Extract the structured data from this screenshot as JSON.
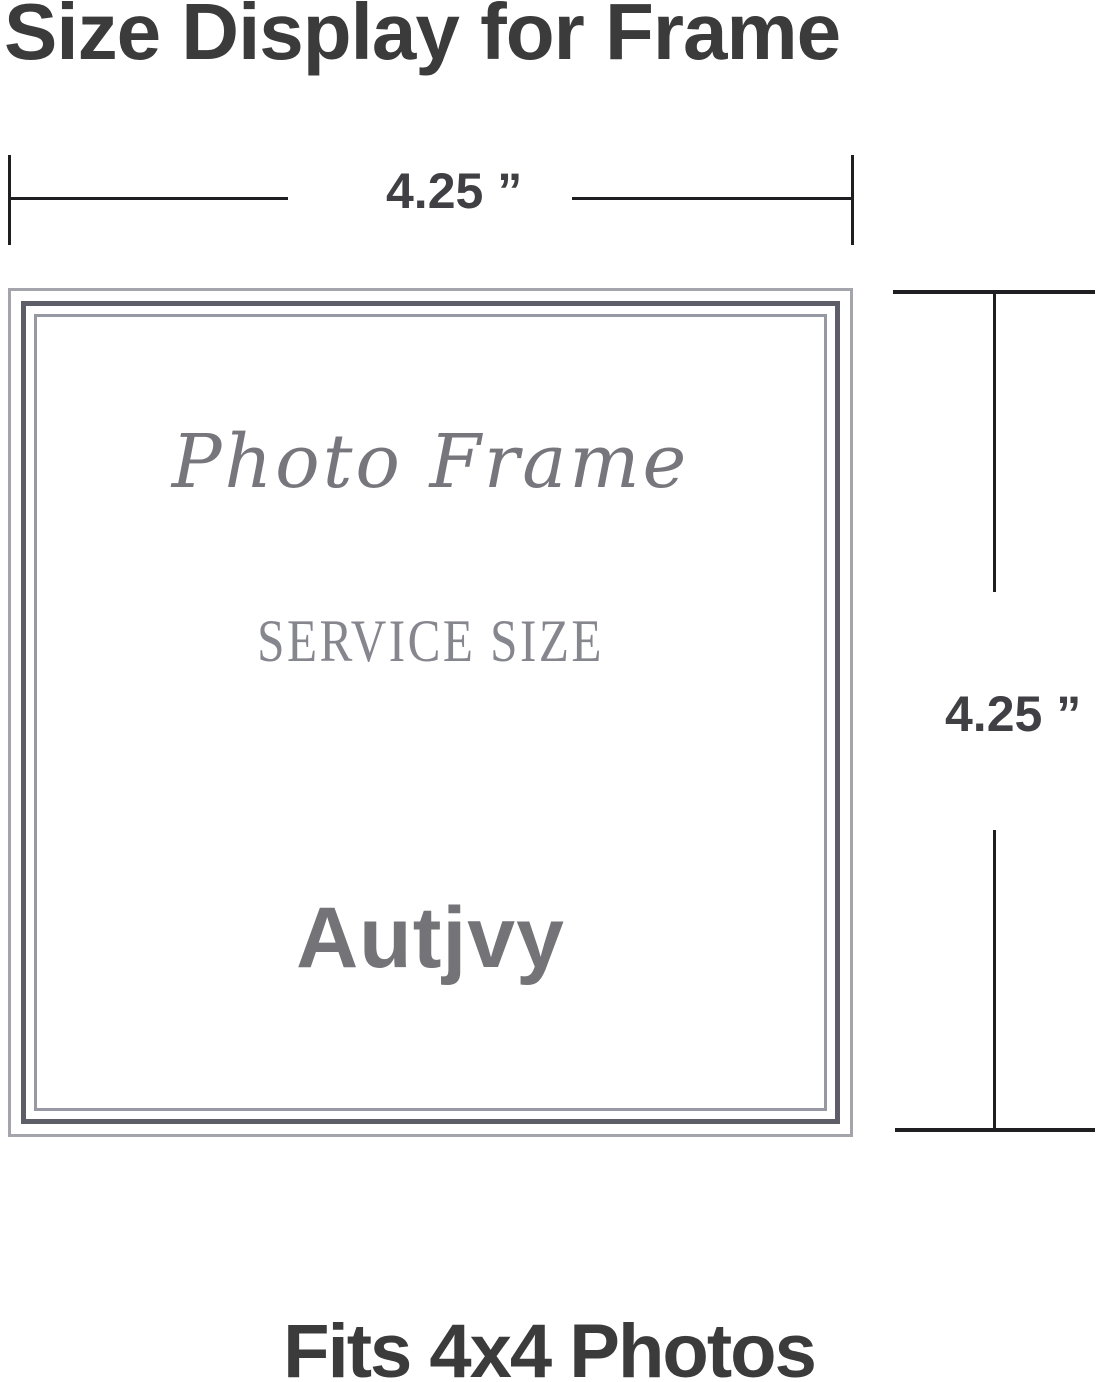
{
  "title": "Size Display for Frame",
  "footer": "Fits 4x4 Photos",
  "width_dimension": {
    "label": "4.25 ”"
  },
  "height_dimension": {
    "label": "4.25 ”"
  },
  "frame": {
    "script_title": "Photo Frame",
    "subtitle": "SERVICE SIZE",
    "brand": "Autjvy"
  },
  "colors": {
    "background": "#ffffff",
    "heading_text": "#3b3b3b",
    "dimension_line": "#1f1f22",
    "dimension_text": "#3f3f44",
    "frame_outer_line": "#a4a4ad",
    "frame_dark_line": "#5e5e68",
    "frame_inner_line": "#9698a3",
    "frame_script_text": "#76767c",
    "frame_subtitle_text": "#86868e",
    "frame_brand_text": "#737378"
  }
}
